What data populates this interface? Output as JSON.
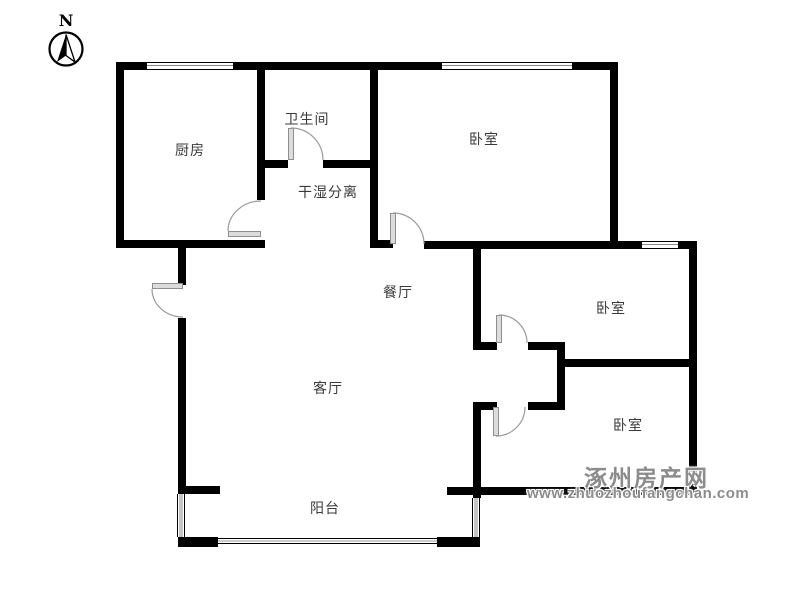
{
  "compass": {
    "label": "N",
    "icon": "north-arrow-icon"
  },
  "rooms": {
    "kitchen": "厨房",
    "bathroom": "卫生间",
    "dry_wet": "干湿分离",
    "bedroom_north": "卧室",
    "dining": "餐厅",
    "living": "客厅",
    "bedroom_east": "卧室",
    "bedroom_southeast": "卧室",
    "balcony": "阳台"
  },
  "watermark": {
    "site_name": "涿州房产网",
    "site_url": "www.zhuozhoufangchan.com"
  },
  "colors": {
    "wall": "#000000",
    "door_leaf": "#dcdcdc",
    "door_arc": "#9a9a9a",
    "label_text": "#3a3a3a",
    "watermark_text": "#8c8c8c",
    "background": "#ffffff"
  }
}
